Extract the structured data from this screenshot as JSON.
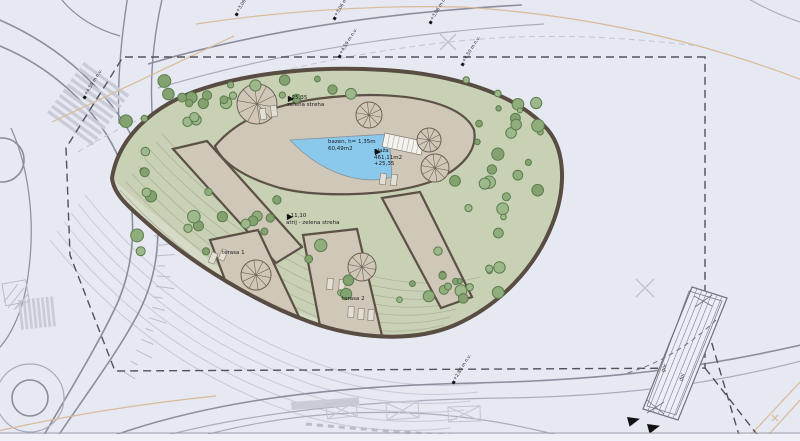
{
  "plan": {
    "labels": {
      "roof": {
        "elevation": "+25,35",
        "name": "zelena streha"
      },
      "pool": {
        "line1": "bazen, h= 1,35m",
        "line2": "60,49m2"
      },
      "beach": {
        "name": "plaža",
        "area": "461,11m2",
        "elevation": "+25,35"
      },
      "atrium": {
        "elevation": "+11,10",
        "name": "atrij - zelena streha"
      },
      "terrace1": "terasa 1",
      "terrace2": "terasa 2",
      "ramp": {
        "up": "gor",
        "down": "dol"
      }
    },
    "boundary_markers": [
      {
        "label": "+4,59 m n.v."
      },
      {
        "label": "+3,08 m n.v."
      },
      {
        "label": "+3,06 m n.v."
      },
      {
        "label": "+4,59 m n.v."
      },
      {
        "label": "+3,06 m n.v."
      },
      {
        "label": "+4,50 m n.v."
      },
      {
        "label": "+2,80 m n.v."
      }
    ],
    "colors": {
      "background": "#e6e8f2",
      "green_roof": "#c8d1b4",
      "terrace_rows_green": "#d6dbc7",
      "hardscape_tan": "#cfc7b7",
      "pool_blue": "#8ac9ec",
      "building_outline": "#584c43",
      "tree_stroke": "#5b7c4d",
      "tree_fills": [
        "#8fae7c",
        "#9db88a",
        "#83a270"
      ],
      "road": "#8a8e9c",
      "road_light": "#a9adbb",
      "stripe": "#c9ccd6",
      "boundary": "#52525c",
      "utility_tan": "#d9bb97",
      "arc_inner": "#b1af9e",
      "arc_outer": "#c7cad6",
      "furniture": "#e3dfd4",
      "marker_black": "#111111"
    }
  }
}
